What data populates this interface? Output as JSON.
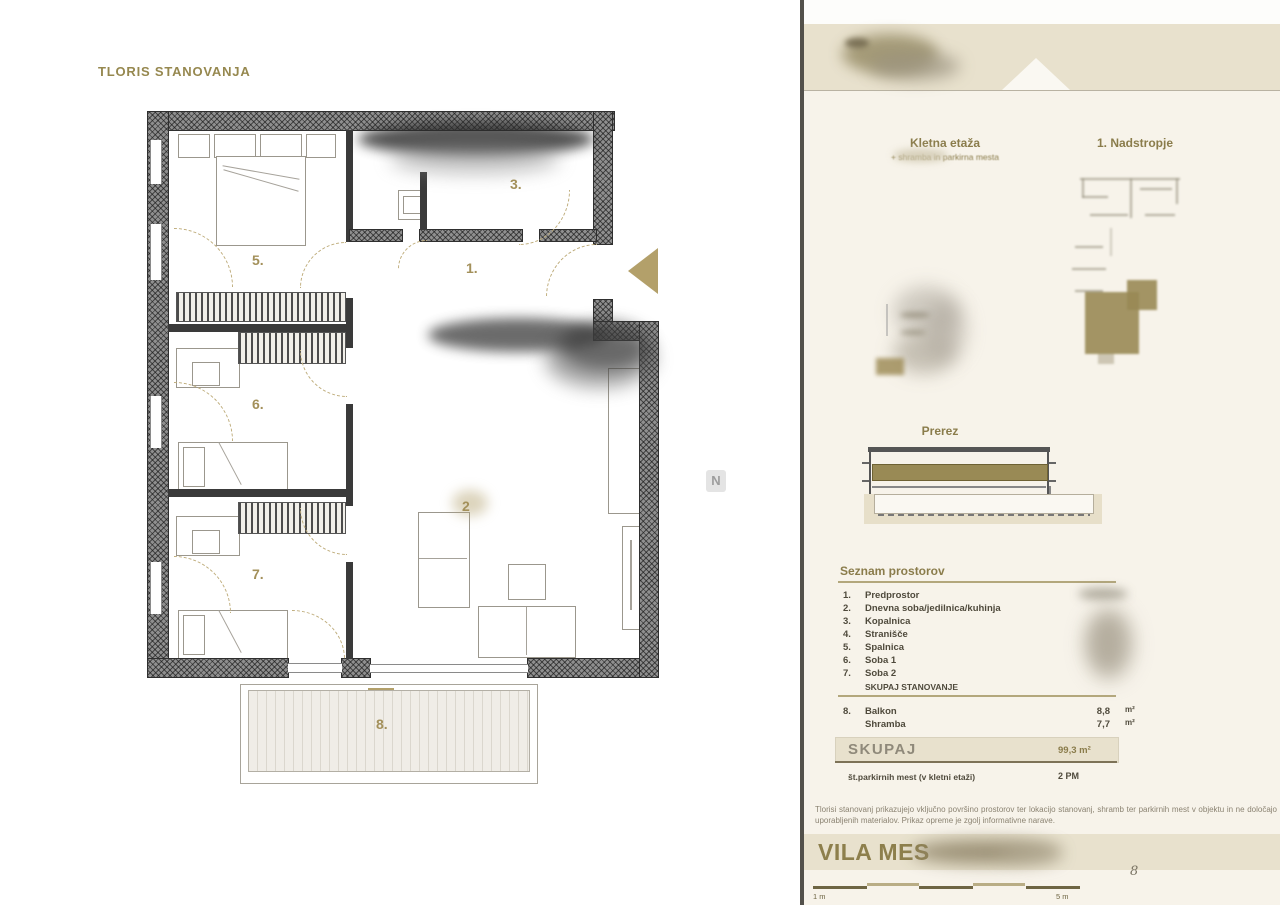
{
  "colors": {
    "accent": "#96884f",
    "banner": "#e8e1cd",
    "sidebar_bg": "#f7f3ea",
    "olive": "#998a55"
  },
  "plan": {
    "title": "TLORIS STANOVANJA",
    "compass": "N",
    "labels": {
      "r1": "1.",
      "r2": "2",
      "r3": "3.",
      "r5": "5.",
      "r6": "6.",
      "r7": "7.",
      "r8": "8."
    }
  },
  "sidebar": {
    "basement_title": "Kletna etaža",
    "basement_subtitle": "+ shramba in parkirna mesta",
    "floor_title": "1. Nadstropje",
    "section_title": "Prerez",
    "rooms_title": "Seznam prostorov",
    "rooms": [
      {
        "num": "1.",
        "label": "Predprostor"
      },
      {
        "num": "2.",
        "label": "Dnevna soba/jedilnica/kuhinja"
      },
      {
        "num": "3.",
        "label": "Kopalnica"
      },
      {
        "num": "4.",
        "label": "Stranišče"
      },
      {
        "num": "5.",
        "label": "Spalnica"
      },
      {
        "num": "6.",
        "label": "Soba 1"
      },
      {
        "num": "7.",
        "label": "Soba 2"
      }
    ],
    "rooms_total_label": "SKUPAJ STANOVANJE",
    "extras": [
      {
        "num": "8.",
        "label": "Balkon",
        "value": "8,8",
        "unit": "m²"
      },
      {
        "num": "",
        "label": "Shramba",
        "value": "7,7",
        "unit": "m²"
      }
    ],
    "total_label": "SKUPAJ",
    "total_value": "99,3 m²",
    "parking_label": "št.parkirnih mest (v kletni etaži)",
    "parking_value": "2 PM",
    "disclaimer": "Tlorisi stanovanj prikazujejo vključno površino prostorov ter lokacijo stanovanj, shramb ter parkirnih mest v objektu in ne določajo uporabljenih materialov. Prikaz opreme je zgolj informativne narave.",
    "brand": "VILA MES",
    "scale_left": "1 m",
    "scale_right": "5 m",
    "page_number": "8"
  }
}
